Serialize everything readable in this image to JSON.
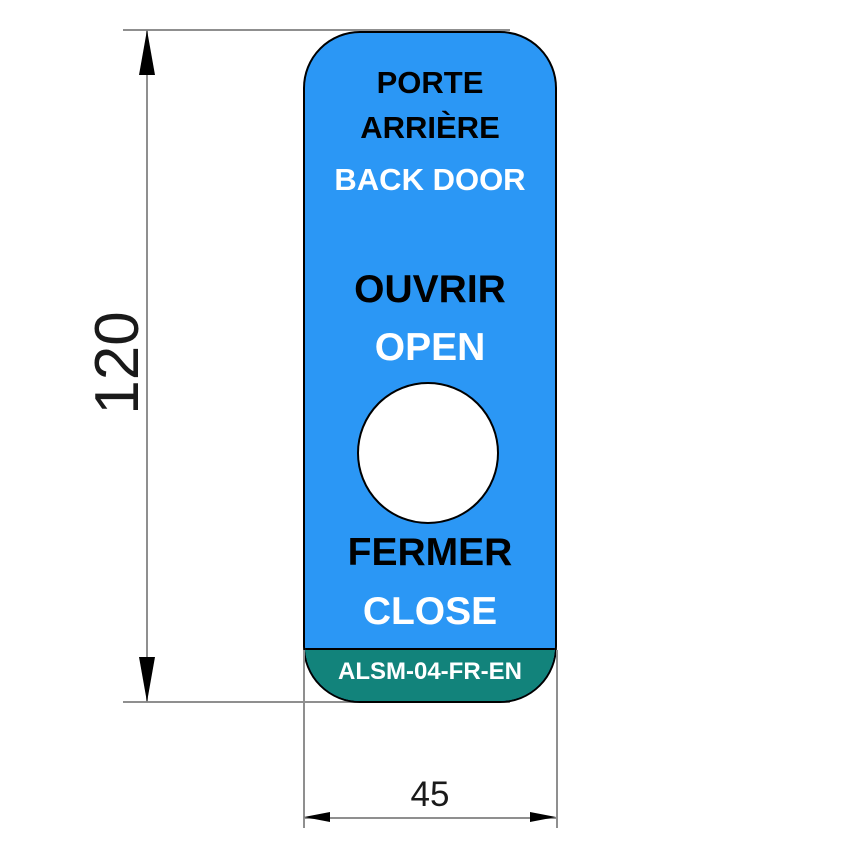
{
  "label": {
    "title_fr_line1": "PORTE",
    "title_fr_line2": "ARRIÈRE",
    "title_en": "BACK DOOR",
    "open_fr": "OUVRIR",
    "open_en": "OPEN",
    "close_fr": "FERMER",
    "close_en": "CLOSE",
    "part_code": "ALSM-04-FR-EN"
  },
  "dimensions": {
    "height_value": "120",
    "width_value": "45"
  },
  "colors": {
    "label_blue": "#2B97F5",
    "band_teal": "#12837B",
    "outline_black": "#000000",
    "hole_white": "#FFFFFF",
    "dim_gray": "#8F8F8F",
    "dim_text": "#1A1A1A",
    "canvas_white": "#FFFFFF"
  }
}
